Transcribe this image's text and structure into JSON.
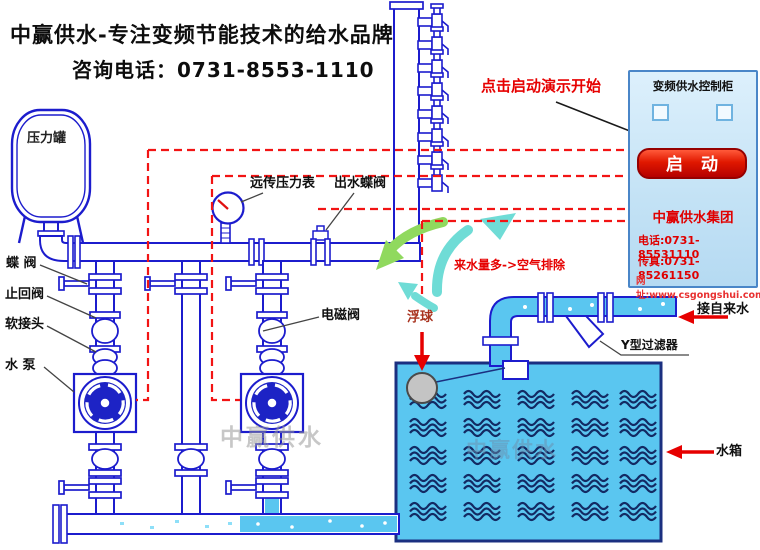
{
  "header": {
    "slogan": "中赢供水-专注变频节能技术的给水品牌",
    "hotline": "咨询电话：0731-8553-1110"
  },
  "demo": {
    "hint": "点击启动演示开始"
  },
  "cabinet": {
    "title": "变频供水控制柜",
    "start_button": "启 动",
    "company": "中赢供水集团",
    "phone": "电话:0731-85531110",
    "fax": "传真:0731-85261150",
    "website": "网址:www.csgongshui.com"
  },
  "labels": {
    "pressure_tank": "压力罐",
    "butterfly_valve": "蝶 阀",
    "check_valve": "止回阀",
    "flex_joint": "软接头",
    "pump": "水 泵",
    "remote_pressure_gauge": "远传压力表",
    "outlet_butterfly_valve": "出水蝶阀",
    "solenoid_valve": "电磁阀",
    "air_release_note": "来水量多->空气排除",
    "float_ball": "浮球",
    "tap_water_inlet": "接自来水",
    "y_filter": "Y型过滤器",
    "water_tank": "水箱"
  },
  "watermark": {
    "text": "中赢供水"
  },
  "colors": {
    "pipe_blue": "#1c1ccd",
    "water_blue": "#5ac6f0",
    "signal_red": "#f21414",
    "accent_red": "#e60000",
    "cabinet_bg": "#cfe9fa",
    "button_red": "#d40000",
    "arrow_green": "#90d95e",
    "arrow_cyan": "#6fdcd6"
  }
}
